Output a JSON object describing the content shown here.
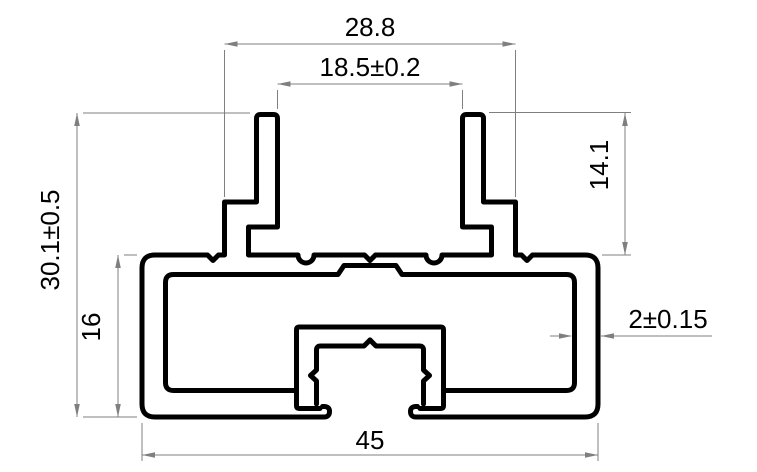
{
  "drawing": {
    "type": "extrusion-profile-cross-section",
    "background_color": "#ffffff",
    "profile_line_color": "#000000",
    "dimension_line_color": "#7f7f7f",
    "text_color": "#000000",
    "dimensions": {
      "fin_outer_width": "28.8",
      "fin_slot_width": "18.5±0.2",
      "fin_height": "14.1",
      "overall_height": "30.1±0.5",
      "body_height": "16",
      "overall_width": "45",
      "wall_thickness": "2±0.15"
    }
  }
}
